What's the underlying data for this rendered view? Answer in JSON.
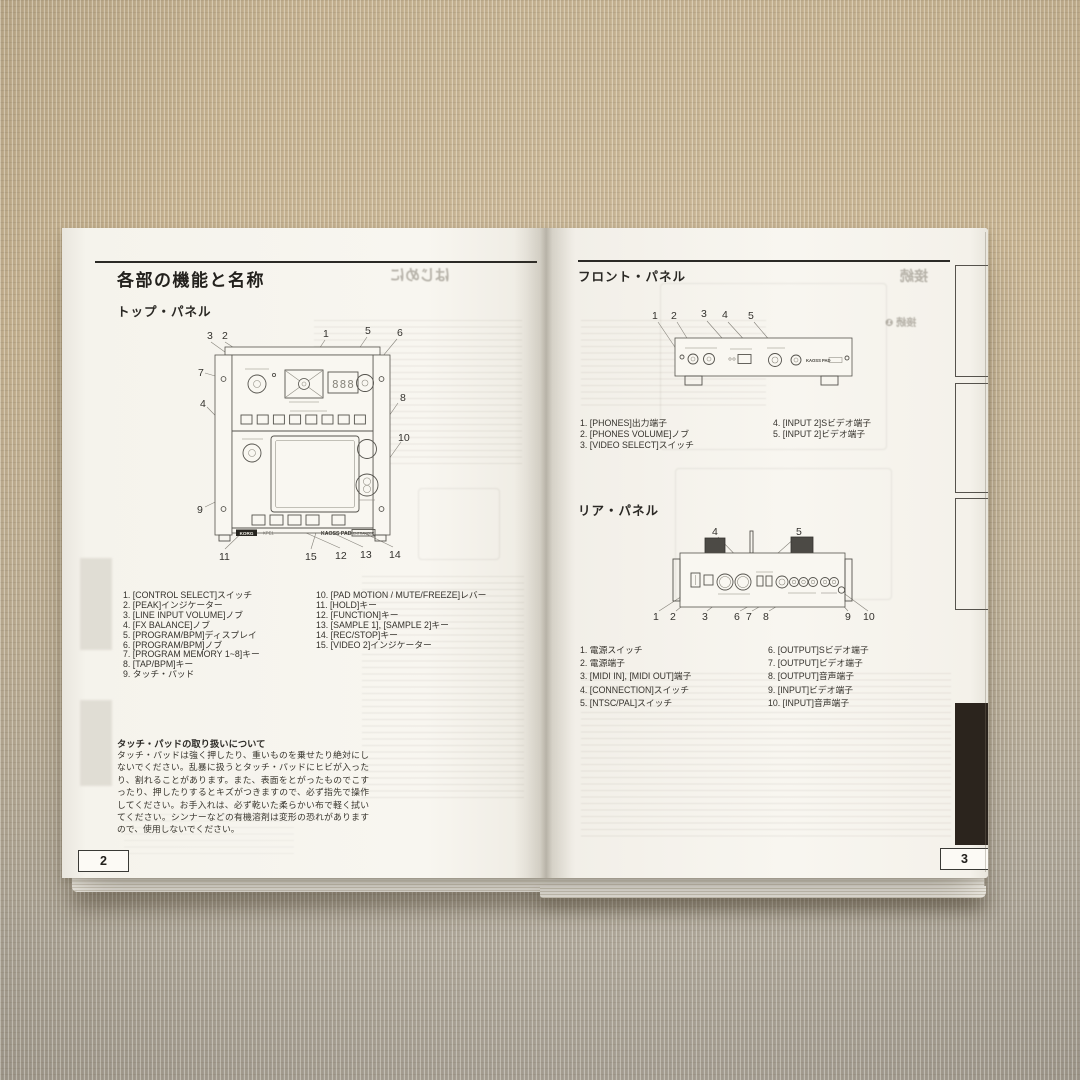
{
  "left_page": {
    "page_number": "2",
    "title": "各部の機能と名称",
    "section_title": "トップ・パネル",
    "diagram": {
      "callouts_top": [
        "3",
        "2",
        "1",
        "5",
        "6"
      ],
      "callouts_left": [
        "7",
        "4",
        "9"
      ],
      "callouts_right": [
        "8",
        "10"
      ],
      "callouts_bottom": [
        "11",
        "15",
        "12",
        "13",
        "14"
      ],
      "display_value": "888",
      "brand_logo": "KORG",
      "model_label": "KPE1",
      "product_logo": "KAOSS PAD",
      "product_logo_badge": "ENTRANCER"
    },
    "items_col1": [
      "1. [CONTROL SELECT]スイッチ",
      "2. [PEAK]インジケーター",
      "3. [LINE INPUT VOLUME]ノブ",
      "4. [FX BALANCE]ノブ",
      "5. [PROGRAM/BPM]ディスプレイ",
      "6. [PROGRAM/BPM]ノブ",
      "7. [PROGRAM MEMORY 1~8]キー",
      "8. [TAP/BPM]キー",
      "9. タッチ・パッド"
    ],
    "items_col2": [
      "10. [PAD MOTION / MUTE/FREEZE]レバー",
      "11. [HOLD]キー",
      "12. [FUNCTION]キー",
      "13. [SAMPLE 1], [SAMPLE 2]キー",
      "14. [REC/STOP]キー",
      "15. [VIDEO 2]インジケーター"
    ],
    "note_title": "タッチ・パッドの取り扱いについて",
    "note_body": "タッチ・パッドは強く押したり、重いものを乗せたり絶対にしないでください。乱暴に扱うとタッチ・パッドにヒビが入ったり、割れることがあります。また、表面をとがったものでこすったり、押したりするとキズがつきますので、必ず指先で操作してください。お手入れは、必ず乾いた柔らかい布で軽く拭いてください。シンナーなどの有機溶剤は変形の恐れがありますので、使用しないでください。",
    "bleedthrough_heading": "はじめに"
  },
  "right_page": {
    "page_number": "3",
    "front_section_title": "フロント・パネル",
    "front_diagram": {
      "callouts": [
        "1",
        "2",
        "3",
        "4",
        "5"
      ],
      "product_logo": "KAOSS PAD"
    },
    "front_items_col1": [
      "1. [PHONES]出力端子",
      "2. [PHONES VOLUME]ノブ",
      "3. [VIDEO SELECT]スイッチ"
    ],
    "front_items_col2": [
      "4. [INPUT 2]Sビデオ端子",
      "5. [INPUT 2]ビデオ端子"
    ],
    "rear_section_title": "リア・パネル",
    "rear_diagram": {
      "callouts_top": [
        "4",
        "5"
      ],
      "callouts_bottom": [
        "1",
        "2",
        "3",
        "6",
        "7",
        "8",
        "9",
        "10"
      ]
    },
    "rear_items_col1": [
      "1. 電源スイッチ",
      "2. 電源端子",
      "3. [MIDI IN], [MIDI OUT]端子",
      "4. [CONNECTION]スイッチ",
      "5. [NTSC/PAL]スイッチ"
    ],
    "rear_items_col2": [
      "6. [OUTPUT]Sビデオ端子",
      "7. [OUTPUT]ビデオ端子",
      "8. [OUTPUT]音声端子",
      "9. [INPUT]ビデオ端子",
      "10. [INPUT]音声端子"
    ],
    "bleedthrough_heading": "接続",
    "bleedthrough_sub": "接続 ❶"
  }
}
